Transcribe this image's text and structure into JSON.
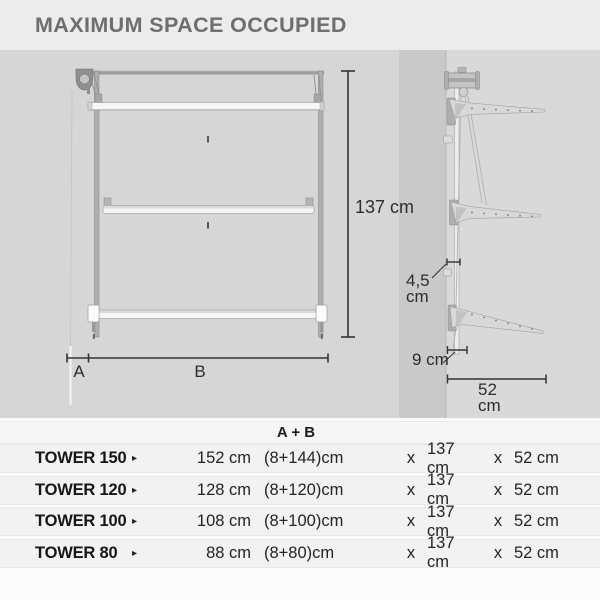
{
  "title": "MAXIMUM SPACE OCCUPIED",
  "diagram": {
    "front": {
      "height_dim": "137 cm",
      "seg_a": "A",
      "seg_b": "B"
    },
    "side": {
      "rail_gap_value": "4,5",
      "rail_gap_unit": "cm",
      "wall_dist": "9 cm",
      "depth_value": "52",
      "depth_unit": "cm"
    }
  },
  "table": {
    "header_ab": "A + B",
    "rows": [
      {
        "model": "TOWER 150",
        "arrow": "▸",
        "total": "152 cm",
        "split": "(8+144)cm",
        "x1": "x",
        "h": "137 cm",
        "x2": "x",
        "d": "52 cm"
      },
      {
        "model": "TOWER 120",
        "arrow": "▸",
        "total": "128 cm",
        "split": "(8+120)cm",
        "x1": "x",
        "h": "137 cm",
        "x2": "x",
        "d": "52 cm"
      },
      {
        "model": "TOWER 100",
        "arrow": "▸",
        "total": "108 cm",
        "split": "(8+100)cm",
        "x1": "x",
        "h": "137 cm",
        "x2": "x",
        "d": "52 cm"
      },
      {
        "model": "TOWER 80",
        "arrow": "▸",
        "total": "88 cm",
        "split": "(8+80)cm",
        "x1": "x",
        "h": "137 cm",
        "x2": "x",
        "d": "52 cm"
      }
    ]
  },
  "colors": {
    "title_text": "#6e6e6e",
    "diagram_bg": "#d6d6d6",
    "wall": "#c9c9c9",
    "dimension_lines": "#333333",
    "table_row_bg": "#f2f2f2"
  }
}
